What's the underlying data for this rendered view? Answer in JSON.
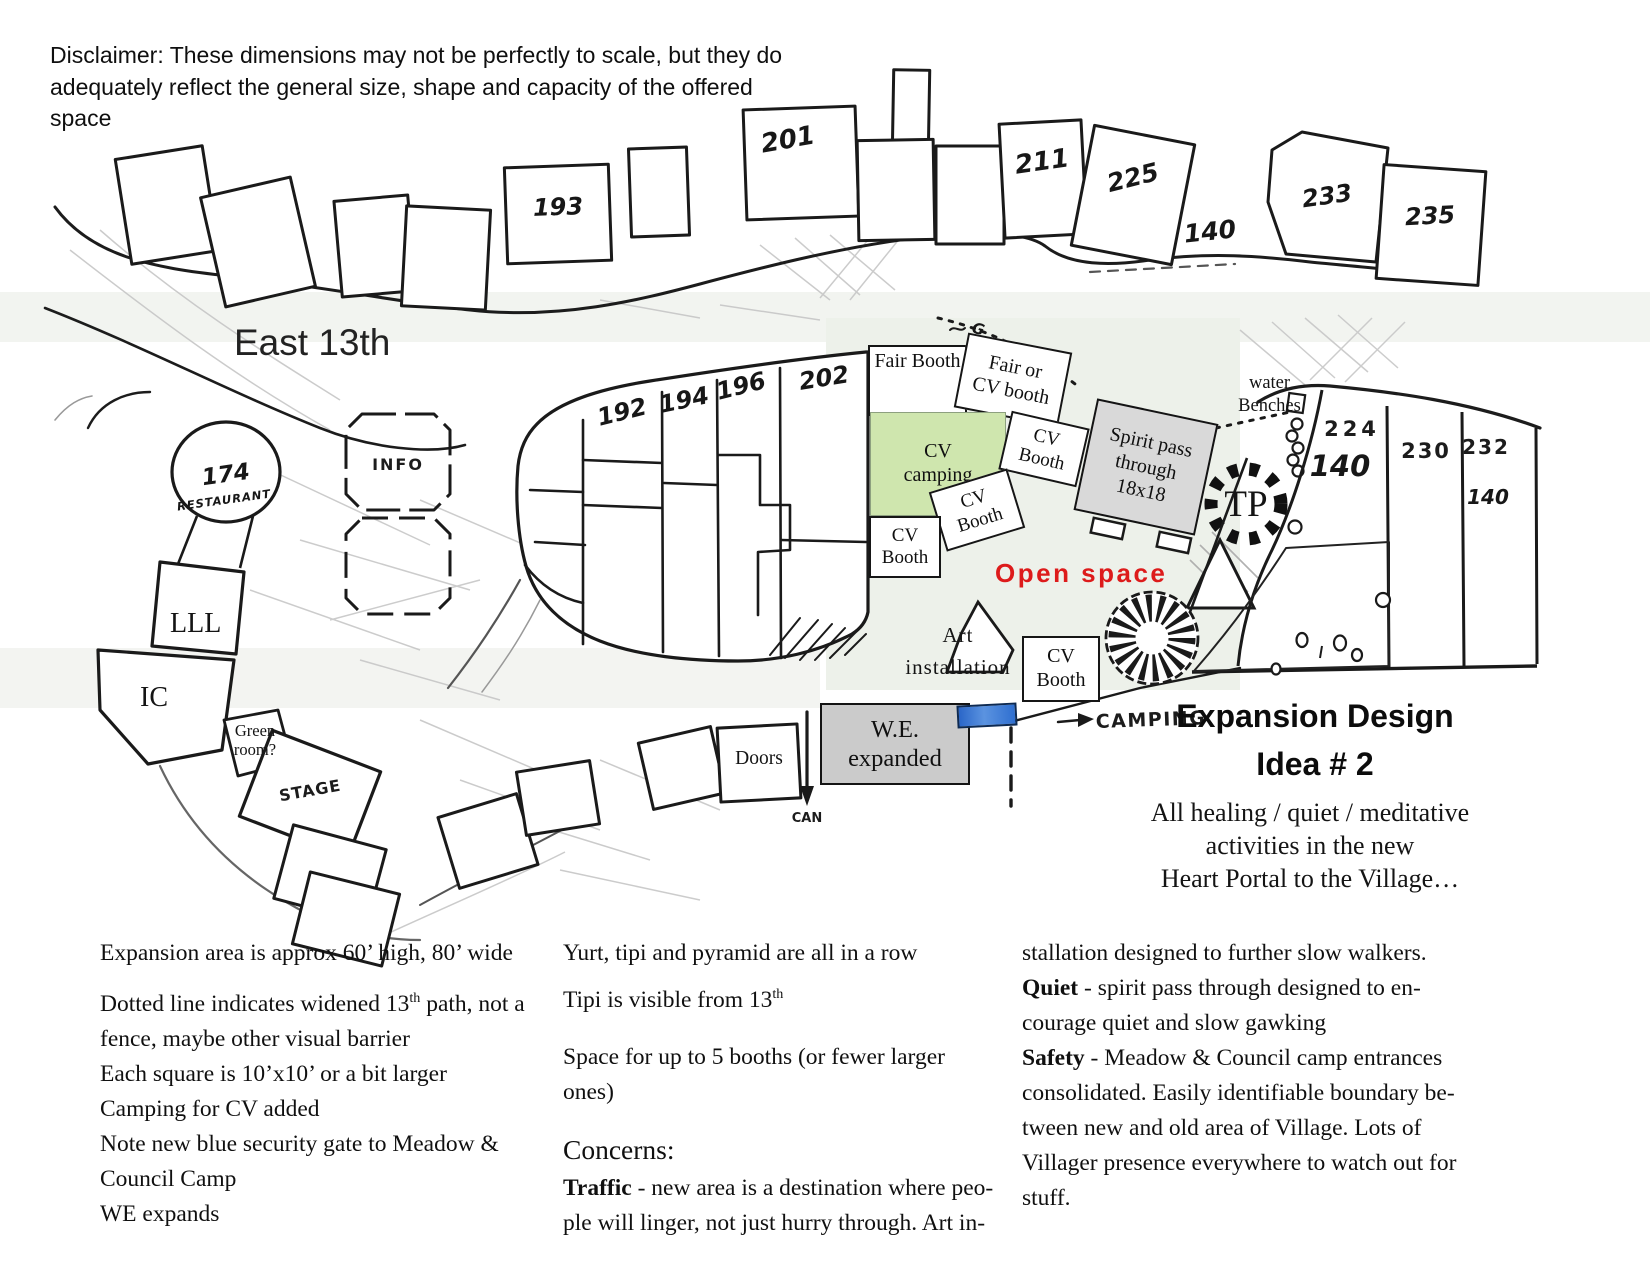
{
  "page": {
    "disclaimer": "Disclaimer: These dimensions may not be perfectly to scale, but they do\nadequately reflect the general size, shape and capacity of the offered space"
  },
  "map": {
    "street_label": "East 13th",
    "open_space_label": "Open space",
    "lots": {
      "l193": "193",
      "l201": "201",
      "l211": "211",
      "l225": "225",
      "l140_top": "140",
      "l233": "233",
      "l235": "235",
      "l192": "192",
      "l194": "194",
      "l196": "196",
      "l202": "202",
      "l174": "174",
      "restaurant": "Restaurant",
      "info": "INFO",
      "l224": "224",
      "l224_cap": "140",
      "l230": "230",
      "l232": "232",
      "l232_cap": "140"
    },
    "features": {
      "lll": "LLL",
      "ic": "IC",
      "green_room": "Green\nroom?",
      "stage": "STAGE",
      "doors": "Doors",
      "tp": "TP",
      "water_benches": "water\nBenches",
      "camping": "CAMPING",
      "can": "CAN",
      "g_mark": "G"
    },
    "booths": {
      "fair_booth": "Fair Booth",
      "fair_or_cv": "Fair or\nCV booth",
      "cv_camping": "CV\ncamping",
      "cv_booth": "CV\nBooth",
      "spirit_pass": "Spirit pass\nthrough\n18x18",
      "art_installation": "Art\ninstallation",
      "we_expanded": "W.E.\nexpanded"
    },
    "colors": {
      "cv_camping_fill": "#cfe6ae",
      "open_space_text": "#dd1b1b",
      "security_gate_blue": "#3273d0",
      "spirit_pass_fill": "#d9d9d9",
      "we_expanded_fill": "#cbcbcb"
    }
  },
  "title": {
    "text": "Expansion Design\nIdea # 2"
  },
  "subtitle": "All healing / quiet / meditative\nactivities in the new\nHeart Portal to the Village…",
  "notes_left": {
    "p1": "Expansion area is approx 60’ high, 80’ wide",
    "p2_pre": "Dotted line indicates widened 13",
    "p2_sup": "th",
    "p2_post": " path, not a\nfence, maybe other visual barrier",
    "p3": "Each square is 10’x10’ or a bit larger",
    "p4": "Camping for CV added",
    "p5": "Note new blue security gate to Meadow &\nCouncil Camp",
    "p6": "WE expands"
  },
  "notes_middle": {
    "p1": "Yurt, tipi and pyramid are all in a row",
    "p2_pre": "Tipi is visible from 13",
    "p2_sup": "th",
    "p3": "Space for up to 5 booths (or fewer larger\nones)",
    "concerns_heading": "Concerns:",
    "traffic_term": "Traffic",
    "traffic_text": " - new area is a destination where peo-\nple will linger, not just hurry through. Art in-"
  },
  "notes_right": {
    "p1": "stallation designed to further slow walkers.\n",
    "quiet_term": "Quiet",
    "quiet_text": " - spirit pass through designed to en-\ncourage quiet and slow gawking\n",
    "safety_term": "Safety",
    "safety_text": " -  Meadow & Council camp entrances\nconsolidated. Easily identifiable boundary be-\ntween new and old area of Village. Lots of\nVillager presence everywhere to watch out for\nstuff."
  }
}
